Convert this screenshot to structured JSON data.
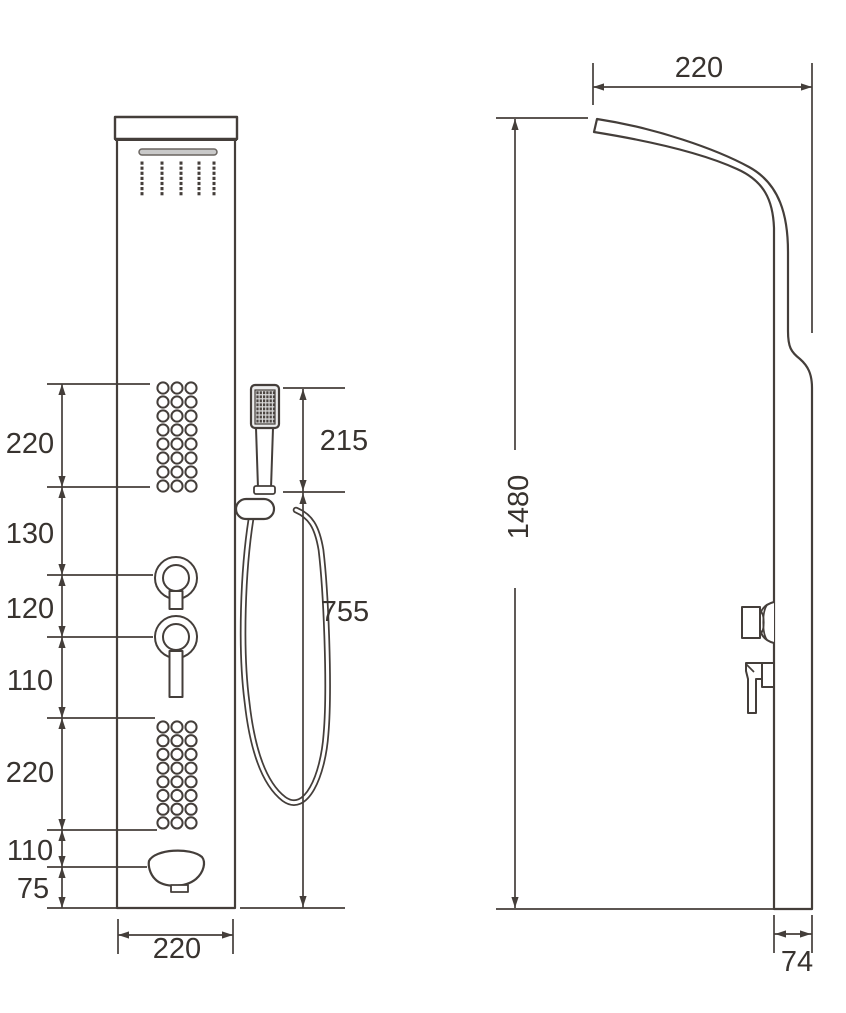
{
  "drawing": {
    "front_view": {
      "left_dimensions": [
        "220",
        "130",
        "120",
        "110",
        "220",
        "110",
        "75"
      ],
      "handshower_height": "215",
      "hose_length": "755",
      "panel_width": "220"
    },
    "side_view": {
      "top_depth": "220",
      "total_height": "1480",
      "panel_thickness": "74"
    },
    "colors": {
      "line": "#443e3a",
      "text": "#38332f",
      "slot_fill": "#c9c9c9"
    }
  }
}
